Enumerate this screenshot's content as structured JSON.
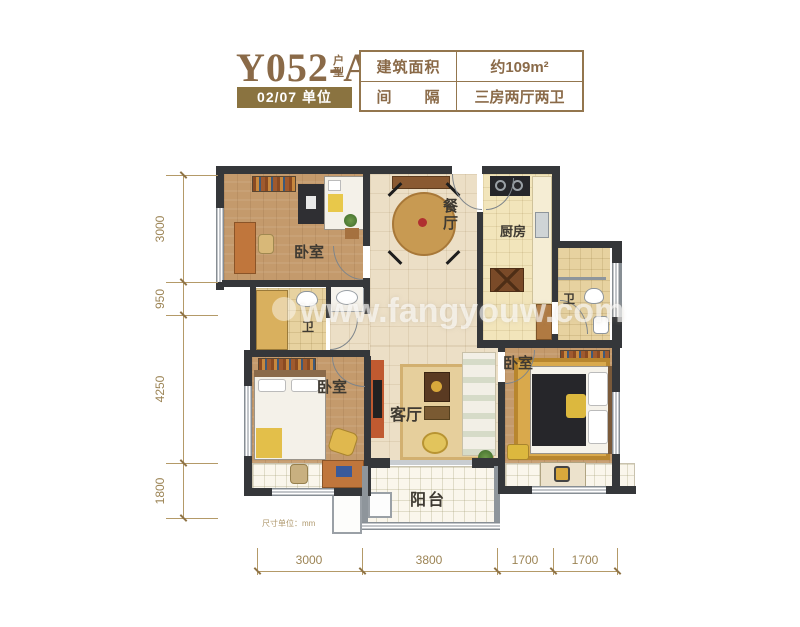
{
  "header": {
    "title": "Y052-A",
    "title_suffix": "户型",
    "unit_badge": "02/07 单位",
    "info_table": {
      "rows": [
        {
          "label": "建筑面积",
          "value": "约109m²"
        },
        {
          "label": "间　　隔",
          "value": "三房两厅两卫"
        }
      ]
    }
  },
  "plan": {
    "rooms": [
      {
        "id": "bedroom-top-left",
        "label": "卧室"
      },
      {
        "id": "dining-room",
        "label": "餐厅"
      },
      {
        "id": "kitchen",
        "label": "厨房"
      },
      {
        "id": "bathroom-right",
        "label": "卫"
      },
      {
        "id": "bathroom-middle",
        "label": "卫"
      },
      {
        "id": "bedroom-bottom-left",
        "label": "卧室"
      },
      {
        "id": "living-room",
        "label": "客厅"
      },
      {
        "id": "bedroom-right",
        "label": "卧室"
      },
      {
        "id": "balcony",
        "label": "阳台"
      }
    ],
    "watermark": "www.fangyouw.com",
    "unit_note": "尺寸单位：mm"
  },
  "dimensions": {
    "left": [
      "3000",
      "950",
      "4250",
      "1800"
    ],
    "bottom": [
      "3000",
      "3800",
      "1700",
      "1700"
    ]
  },
  "colors": {
    "accent_brown": "#8a6a48",
    "badge_bg": "#8a7340",
    "dimension_tan": "#a68e5e",
    "wall_dark": "#35373a"
  }
}
